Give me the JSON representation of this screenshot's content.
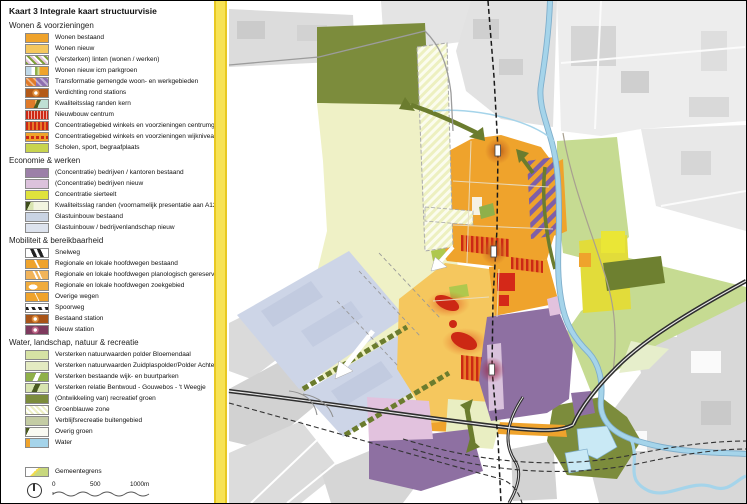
{
  "title": "Kaart 3 Integrale kaart structuurvisie",
  "legend": {
    "sections": [
      {
        "header": "Wonen & voorzieningen",
        "items": [
          {
            "label": "Wonen bestaand",
            "swatch": "wonen-bestaand"
          },
          {
            "label": "Wonen nieuw",
            "swatch": "wonen-nieuw"
          },
          {
            "label": "(Versterken) linten (wonen / werken)",
            "swatch": "linten"
          },
          {
            "label": "Wonen nieuw icm parkgroen",
            "swatch": "parkgroen"
          },
          {
            "label": "Transformatie gemengde woon- en werkgebieden",
            "swatch": "transformatie"
          },
          {
            "label": "Verdichting rond stations",
            "swatch": "verdichting"
          },
          {
            "label": "Kwaliteitsslag randen kern",
            "swatch": "kwalrand-kern"
          },
          {
            "label": "Nieuwbouw centrum",
            "swatch": "nieuwbouw"
          },
          {
            "label": "Concentratiegebied winkels en voorzieningen centrumgebied",
            "swatch": "conc-centrum"
          },
          {
            "label": "Concentratiegebied winkels en voorzieningen wijkniveau",
            "swatch": "conc-wijk"
          },
          {
            "label": "Scholen, sport, begraafplaats",
            "swatch": "scholen"
          }
        ]
      },
      {
        "header": "Economie & werken",
        "items": [
          {
            "label": "(Concentratie) bedrijven / kantoren bestaand",
            "swatch": "bedrijven-bestaand"
          },
          {
            "label": "(Concentratie) bedrijven nieuw",
            "swatch": "bedrijven-nieuw"
          },
          {
            "label": "Concentratie sierteelt",
            "swatch": "sierteelt"
          },
          {
            "label": "Kwaliteitsslag randen (voornamelijk presentatie aan A12)",
            "swatch": "kwalrand-a12"
          },
          {
            "label": "Glastuinbouw bestaand",
            "swatch": "glas-bestaand"
          },
          {
            "label": "Glastuinbouw / bedrijvenlandschap nieuw",
            "swatch": "glas-nieuw"
          }
        ]
      },
      {
        "header": "Mobiliteit & bereikbaarheid",
        "items": [
          {
            "label": "Snelweg",
            "swatch": "snelweg"
          },
          {
            "label": "Regionale en lokale hoofdwegen bestaand",
            "swatch": "hoofdweg-bestaand"
          },
          {
            "label": "Regionale en lokale hoofdwegen planologisch gereserveerd",
            "swatch": "hoofdweg-plan"
          },
          {
            "label": "Regionale en lokale hoofdwegen zoekgebied",
            "swatch": "hoofdweg-zoek"
          },
          {
            "label": "Overige wegen",
            "swatch": "overige-wegen"
          },
          {
            "label": "Spoorweg",
            "swatch": "spoorweg"
          },
          {
            "label": "Bestaand station",
            "swatch": "station-bestaand"
          },
          {
            "label": "Nieuw station",
            "swatch": "station-nieuw"
          }
        ]
      },
      {
        "header": "Water, landschap, natuur & recreatie",
        "items": [
          {
            "label": "Versterken natuurwaarden polder Bloemendaal",
            "swatch": "natuur-bloemendaal"
          },
          {
            "label": "Versterken natuurwaarden Zuidplaspolder/Polder Achterof",
            "swatch": "natuur-zuidplas"
          },
          {
            "label": "Versterken bestaande wijk- en buurtparken",
            "swatch": "parken"
          },
          {
            "label": "Versterken relatie Bentwoud - Gouwebos - 't Weegje",
            "swatch": "relatie"
          },
          {
            "label": "(Ontwikkeling van) recreatief groen",
            "swatch": "recreatief"
          },
          {
            "label": "Groenblauwe zone",
            "swatch": "groenblauw"
          },
          {
            "label": "Verblijfsrecreatie buitengebied",
            "swatch": "verblijf"
          },
          {
            "label": "Overig groen",
            "swatch": "overig-groen"
          },
          {
            "label": "Water",
            "swatch": "water"
          }
        ]
      }
    ],
    "boundary": {
      "label": "Gemeentegrens",
      "swatch": "gemeentegrens"
    },
    "scale": {
      "ticks": [
        "0",
        "500",
        "1000m"
      ]
    }
  },
  "colors": {
    "boundary_yellow": "#F7E254",
    "housing_orange": "#EFA32C",
    "housing_new_orange": "#F5C75E",
    "business_purple": "#8E70A2",
    "business_new_pink": "#E2C2DE",
    "greenhouse_bluegray": "#CDD5E7",
    "recreation_olive": "#7C8C3C",
    "nature_lightgreen": "#C6DB92",
    "polder_paleyellow": "#EFF1C6",
    "sierteelt_yellow": "#DFE23C",
    "water_blue": "#A5D4EA",
    "urban_gray": "#DCDCDC",
    "red_accent": "#CC2814",
    "station_glow": "#B45A18",
    "new_station_glow": "#7E3A5E"
  }
}
